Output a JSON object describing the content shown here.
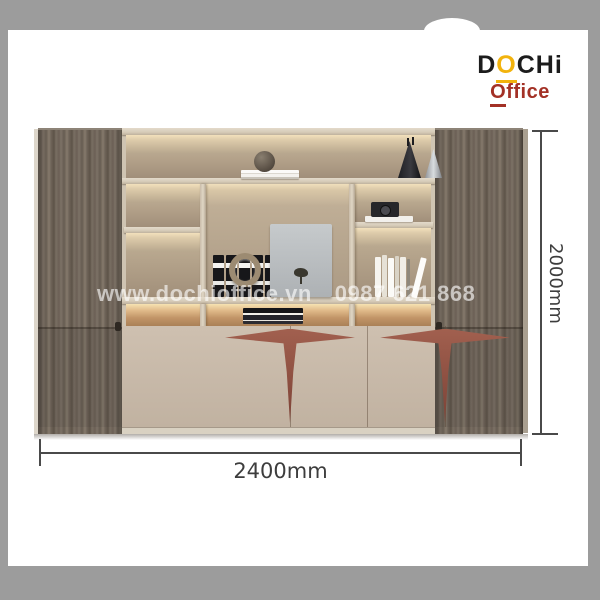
{
  "brand": {
    "line1": {
      "d": "D",
      "o": "O",
      "rest": "CHi"
    },
    "line2": {
      "o": "O",
      "rest": "ffice"
    },
    "colors": {
      "black": "#1c1c1c",
      "yellow": "#f2b30d",
      "red": "#a33126"
    }
  },
  "watermark": {
    "website": "www.dochioffice.vn",
    "phone": "0987 621 868"
  },
  "dimensions": {
    "width_label": "2400mm",
    "height_label": "2000mm"
  },
  "product": {
    "type": "office-bookcase-cabinet",
    "accent_color": "#96544a",
    "wood_color": "#6e6459",
    "shelf_light_color": "#f2e0bc",
    "door_color": "#c6b7a8",
    "background_frame_color": "#9c9c9c",
    "decor_items": [
      "decorative-sphere-on-books",
      "dark-cone-vase",
      "silver-cone-vase",
      "camera-on-white-books",
      "five-black-ring-binders",
      "metal-ring-sculpture",
      "leaning-canvas-with-bonsai",
      "white-book-row",
      "flat-book-stack"
    ]
  }
}
